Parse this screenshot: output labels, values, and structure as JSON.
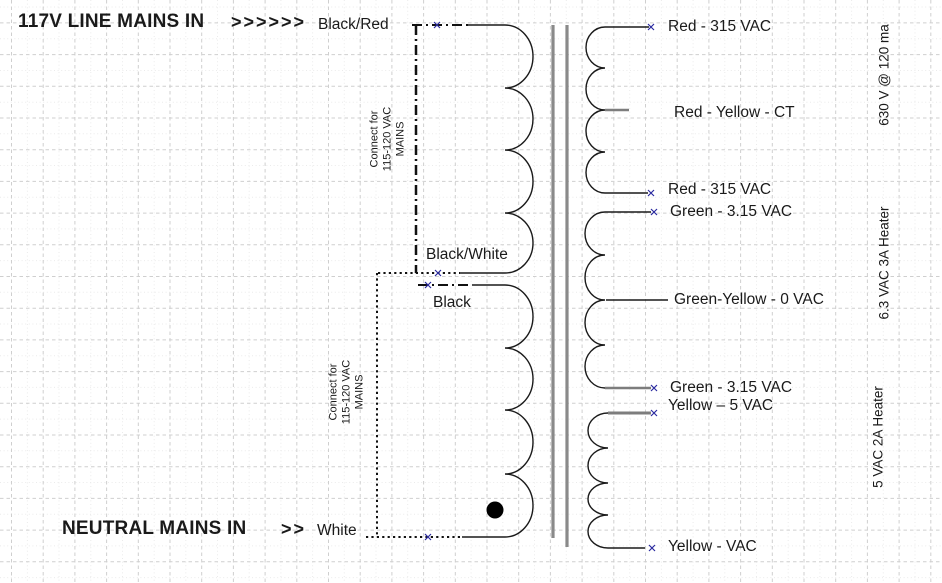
{
  "palette": {
    "wire": "#1a1a1a",
    "core": "#8a8a8a",
    "gray_lead": "#7d7d7d",
    "terminal_marker": "#2a2aa0",
    "grid_major": "#cfcfcf",
    "grid_minor": "#e9e9e9",
    "background": "#ffffff"
  },
  "mains": {
    "line_title": "117V LINE MAINS IN",
    "line_chevrons": ">>>>>>",
    "line_wire_label": "Black/Red",
    "neutral_title": "NEUTRAL MAINS IN",
    "neutral_chevrons": ">>",
    "neutral_wire_label": "White"
  },
  "primary": {
    "tap_black_white_label": "Black/White",
    "tap_black_label": "Black",
    "jumper_note_upper": "Connect for\n115-120 VAC\nMAINS",
    "jumper_note_lower": "Connect for\n115-120 VAC\nMAINS"
  },
  "secondary": {
    "terminals": [
      {
        "label": "Red  - 315 VAC"
      },
      {
        "label": "Red - Yellow - CT"
      },
      {
        "label": "Red  - 315 VAC"
      },
      {
        "label": "Green  - 3.15 VAC"
      },
      {
        "label": "Green-Yellow  - 0 VAC"
      },
      {
        "label": "Green  - 3.15 VAC"
      },
      {
        "label": "Yellow – 5 VAC"
      },
      {
        "label": "Yellow  -  VAC"
      }
    ],
    "winding_ratings": [
      {
        "label": "630 V @ 120 ma"
      },
      {
        "label": "6.3 VAC 3A Heater"
      },
      {
        "label": "5 VAC 2A Heater"
      }
    ]
  }
}
